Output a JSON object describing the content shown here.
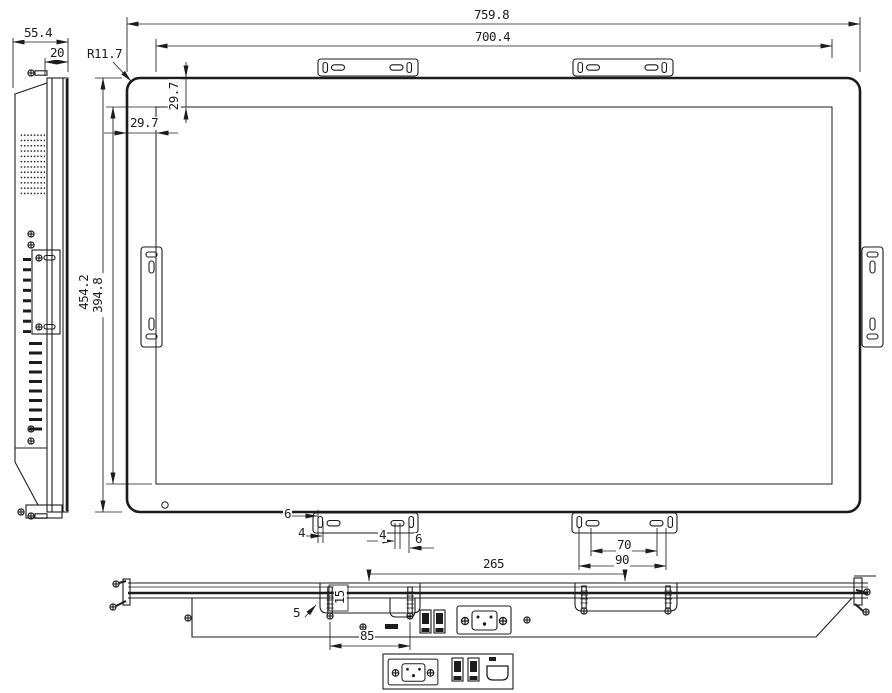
{
  "drawing": {
    "type": "technical-dimension-drawing",
    "subject": "open-frame monitor with mounting brackets and IO panel",
    "views": {
      "side_view": "side profile",
      "front_view": "front elevation",
      "bottom_view": "bottom profile",
      "io_detail": "connector panel detail"
    },
    "dims": {
      "side_depth": "55.4",
      "front_frame_depth": "20",
      "corner_radius": "R11.7",
      "overall_width": "759.8",
      "glass_width": "700.4",
      "top_margin": "29.7",
      "side_margin": "29.7",
      "overall_height": "454.2",
      "glass_height": "394.8",
      "left_bracket_edge_offset": "6",
      "left_bracket_slot_width": "4",
      "right_bracket_slot_width": "4",
      "right_bracket_edge_offset": "6",
      "bracket_slot_spacing": "70",
      "bracket_slot_outer_spacing": "90",
      "bracket_center_distance": "265",
      "stud_length": "15",
      "stud_edge_offset": "5",
      "stud_spacing": "85"
    },
    "icons": [
      "phillips-screw-icon",
      "power-inlet-icon",
      "usb-port-icon",
      "hdmi-port-icon",
      "speaker-grille",
      "vent-slots"
    ]
  },
  "colors": {
    "line": "#1c1c1c",
    "background": "#ffffff"
  }
}
